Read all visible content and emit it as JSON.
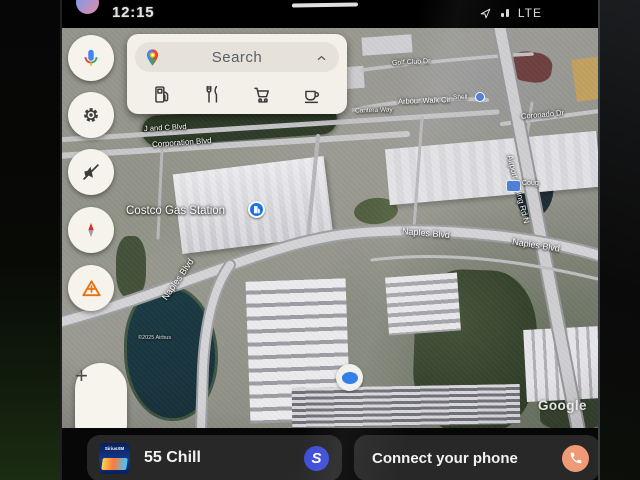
{
  "colors": {
    "accent_blue": "#1a73e8",
    "poi_pin_blue": "#4d7fd6",
    "phone_button_orange": "#ef9a76",
    "media_app_blue": "#3f4ed8"
  },
  "status_bar": {
    "time": "12:15",
    "network": "LTE",
    "icons": [
      "avatar",
      "location-arrow",
      "signal-bars"
    ]
  },
  "search_panel": {
    "label": "Search",
    "logo_icon": "google-maps-pin",
    "collapse_icon": "chevron-up",
    "categories": [
      {
        "icon": "gas-station"
      },
      {
        "icon": "restaurants"
      },
      {
        "icon": "shopping-cart"
      },
      {
        "icon": "coffee"
      }
    ]
  },
  "sidebar": {
    "buttons": [
      {
        "icon": "microphone"
      },
      {
        "icon": "settings-gear"
      },
      {
        "icon": "volume-muted"
      },
      {
        "icon": "compass"
      },
      {
        "icon": "report-hazard"
      }
    ]
  },
  "map": {
    "view": "satellite",
    "labels": [
      {
        "text": "J and C Blvd"
      },
      {
        "text": "Corporation Blvd"
      },
      {
        "text": "Costco Gas Station",
        "icon": "gas-pump-pin"
      },
      {
        "text": "Golf Club Dr"
      },
      {
        "text": "Cantera Way"
      },
      {
        "text": "Arbour Walk Cir"
      },
      {
        "text": "Shell",
        "icon": "poi-pin"
      },
      {
        "text": "Coronado Dr"
      },
      {
        "text": "Airport Pulling Rd N"
      },
      {
        "text": "Coug",
        "icon": "poi-pin"
      },
      {
        "text": "Naples Blvd"
      },
      {
        "text": "Naples Blvd"
      },
      {
        "text": "Naples Blvd"
      },
      {
        "text": "©2025 Airbus"
      }
    ],
    "watermark": "Google",
    "location_indicator": "current-location-dot"
  },
  "zoom_control": {
    "zoom_in": "+",
    "zoom_out": "−"
  },
  "media_card": {
    "title": "55 Chill",
    "art_label": "SiriusXM",
    "app_icon_letter": "S"
  },
  "phone_card": {
    "title": "Connect your phone",
    "icon": "phone"
  }
}
